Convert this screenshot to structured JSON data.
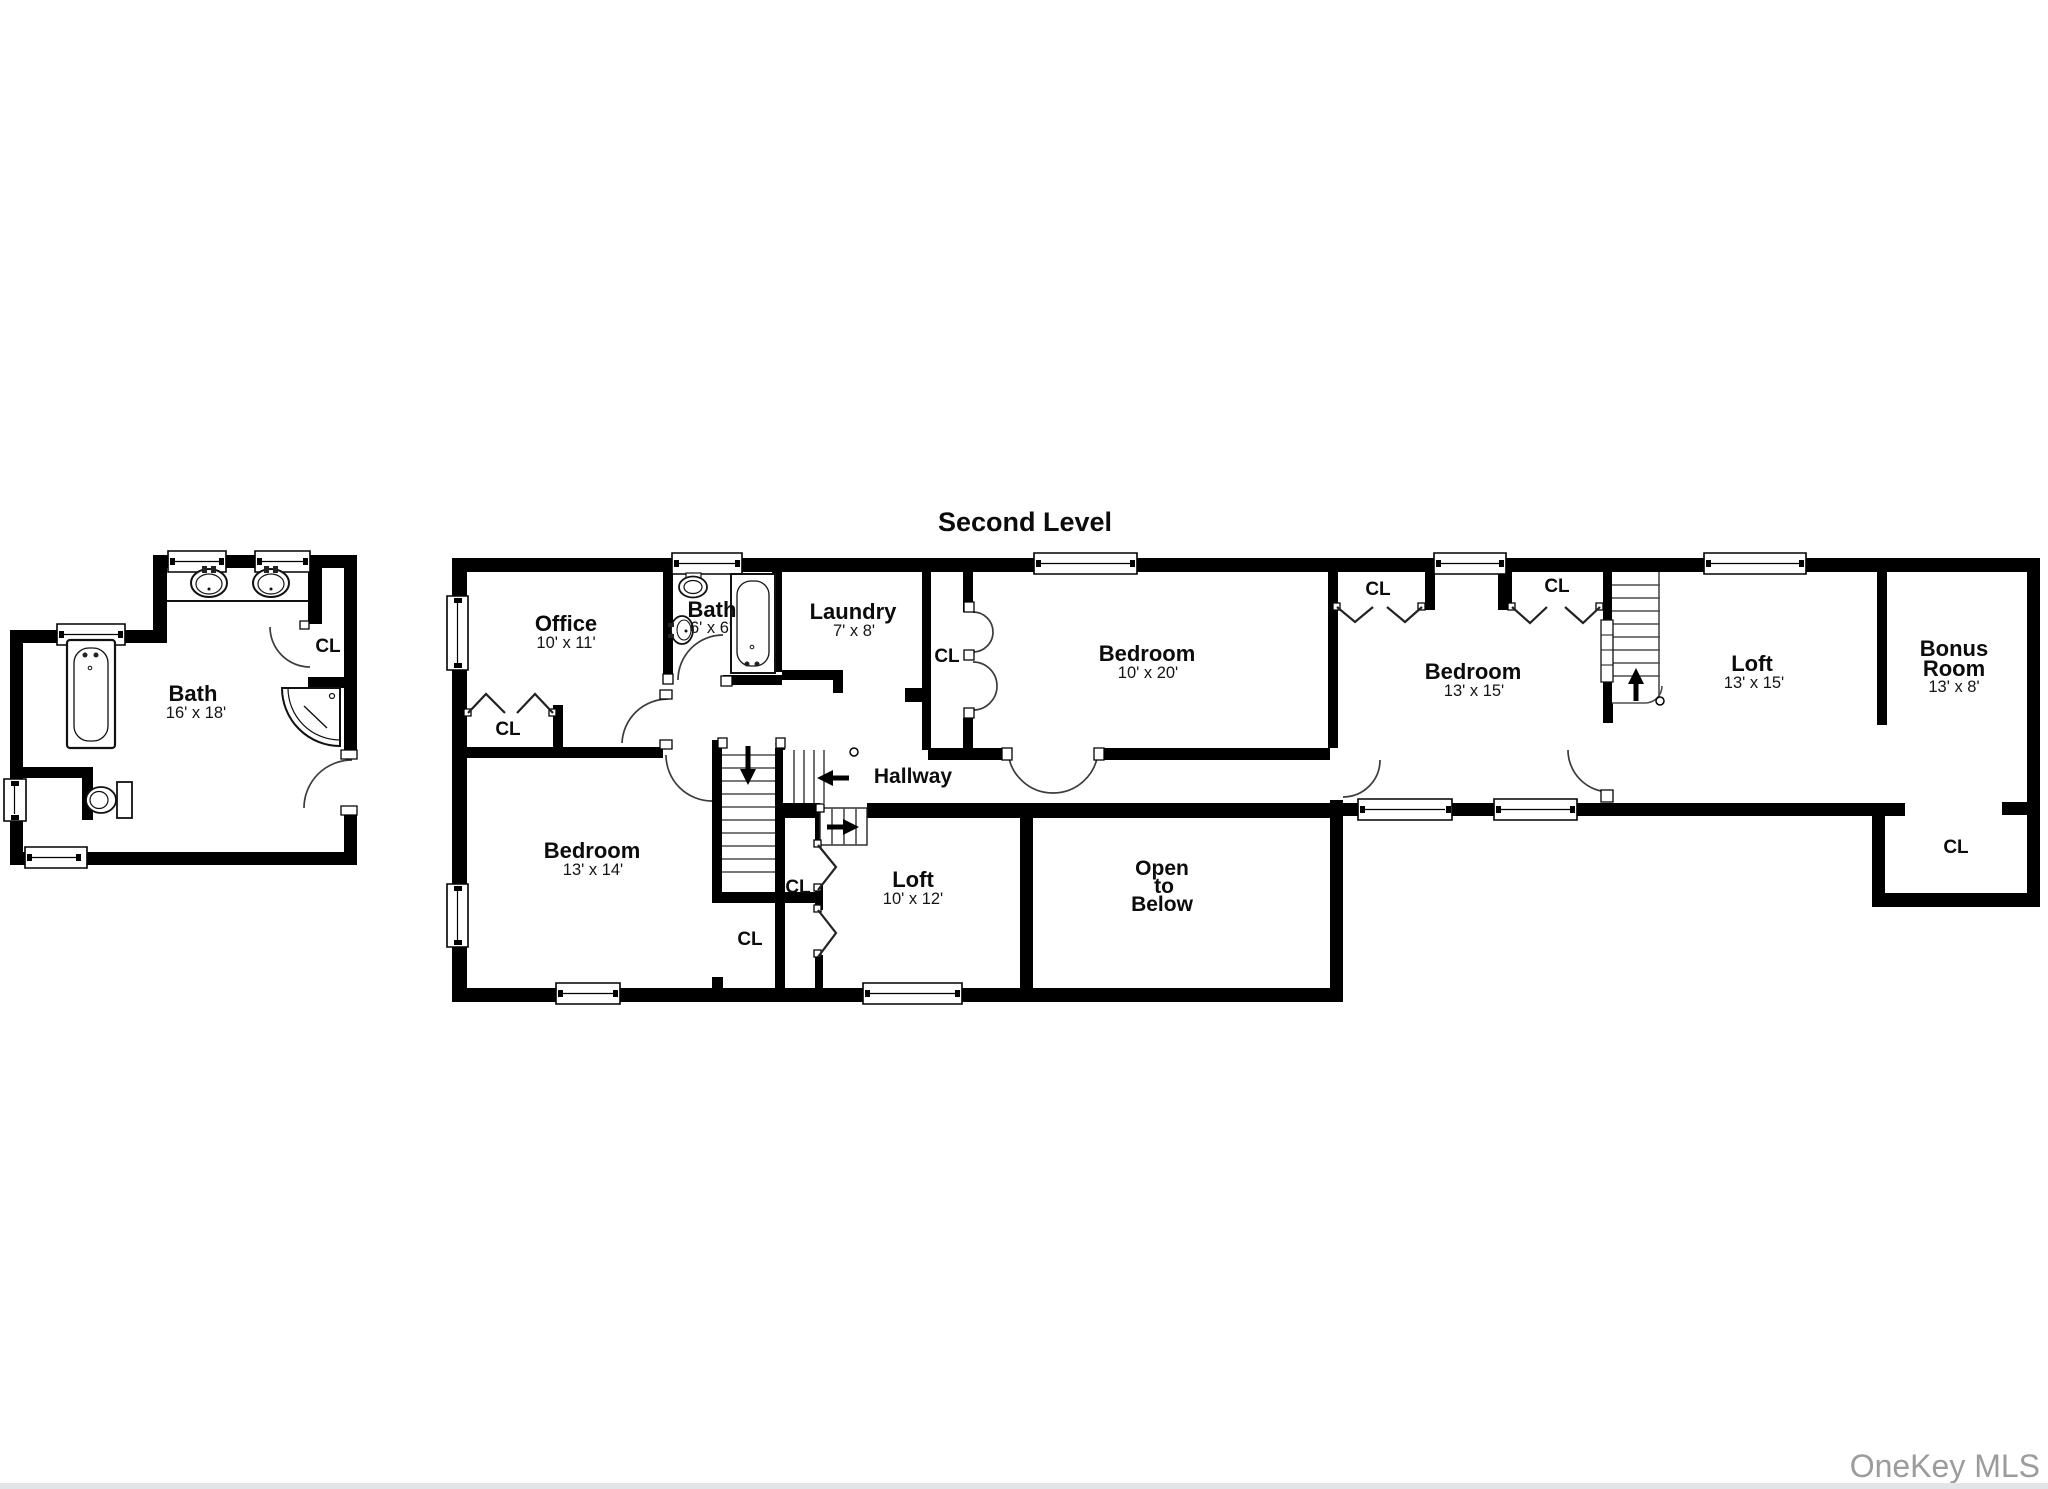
{
  "title": "Second Level",
  "watermark": "OneKey MLS",
  "colors": {
    "wall": "#000000",
    "background": "#ffffff",
    "watermark": "#9c9c9c"
  },
  "labels": {
    "closet": "CL",
    "hallway": "Hallway",
    "open_to_below": {
      "line1": "Open",
      "line2": "to",
      "line3": "Below"
    }
  },
  "rooms": {
    "primary_bath": {
      "name": "Bath",
      "dims": "16' x 18'"
    },
    "office": {
      "name": "Office",
      "dims": "10' x 11'"
    },
    "small_bath": {
      "name": "Bath",
      "dims": "6' x 6'"
    },
    "laundry": {
      "name": "Laundry",
      "dims": "7' x 8'"
    },
    "bedroom_10x20": {
      "name": "Bedroom",
      "dims": "10' x 20'"
    },
    "bedroom_13x15": {
      "name": "Bedroom",
      "dims": "13' x 15'"
    },
    "loft_13x15": {
      "name": "Loft",
      "dims": "13' x 15'"
    },
    "bonus_room": {
      "name_line1": "Bonus",
      "name_line2": "Room",
      "dims": "13' x 8'"
    },
    "bedroom_13x14": {
      "name": "Bedroom",
      "dims": "13' x 14'"
    },
    "loft_10x12": {
      "name": "Loft",
      "dims": "10' x 12'"
    }
  }
}
